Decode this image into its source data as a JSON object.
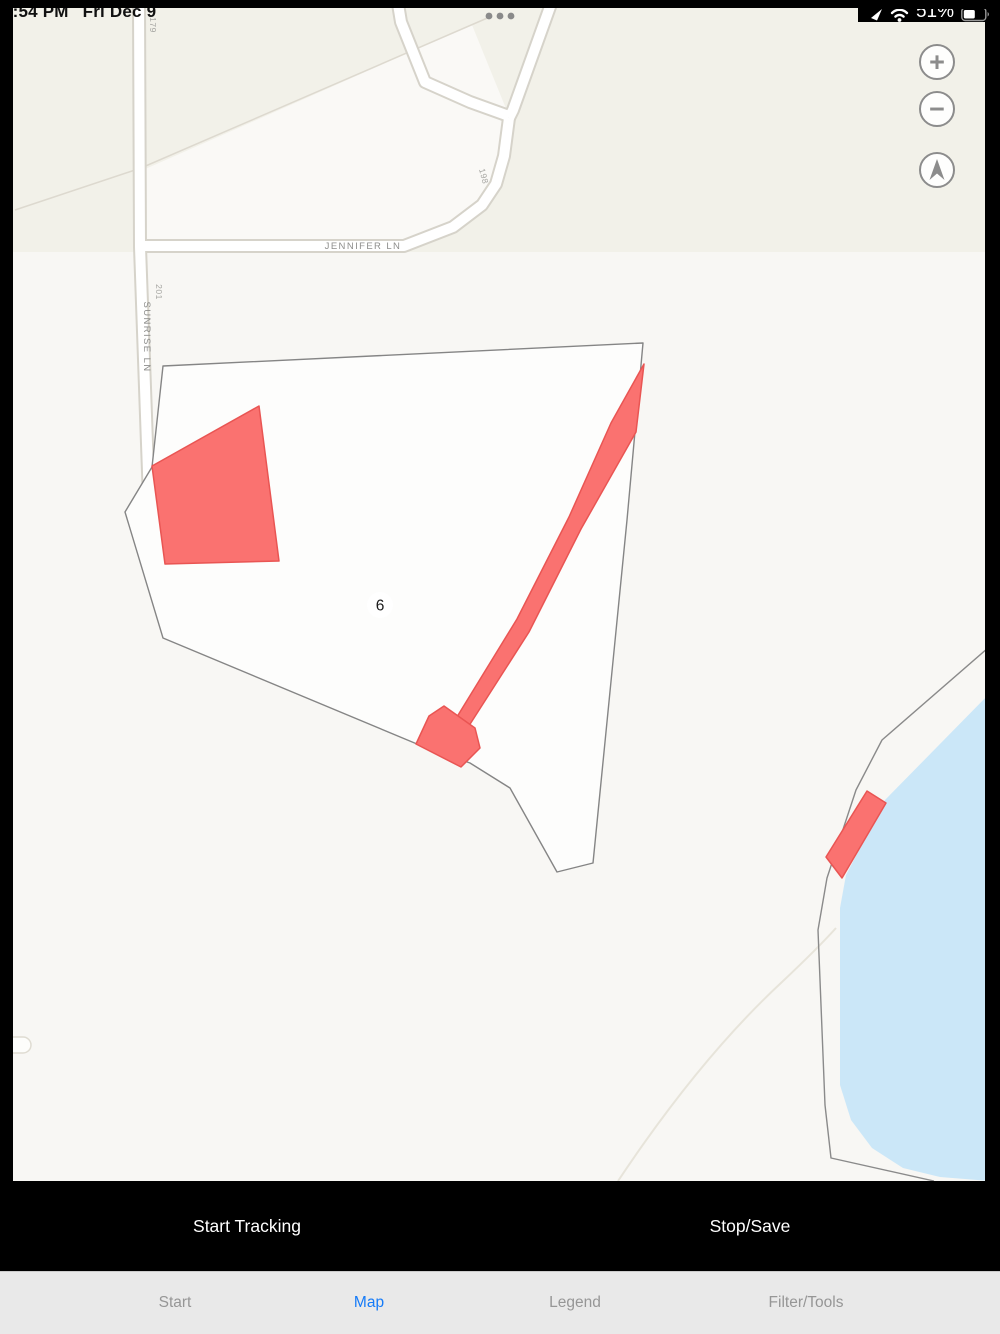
{
  "status_bar": {
    "time": "3:54 PM",
    "date": "Fri Dec 9",
    "battery_percent": "51%",
    "icons": [
      "location-arrow-icon",
      "wifi-icon",
      "battery-icon"
    ]
  },
  "map": {
    "street_labels": {
      "jennifer": "JENNIFER LN",
      "sunrise": "SUNRISE LN"
    },
    "address_labels": {
      "a179": "179",
      "a201": "201",
      "a198": "198"
    },
    "parcel_number": "6",
    "colors": {
      "highlight_red": "#fa7270",
      "highlight_red_stroke": "#e95553",
      "water_blue": "#cbe7f8",
      "parcel_outline_gray": "#858585",
      "map_background": "#f8f7f4"
    }
  },
  "controls": {
    "zoom_in_label": "+",
    "zoom_out_label": "−",
    "compass": "compass-north-icon"
  },
  "action_bar": {
    "start_tracking_label": "Start Tracking",
    "stop_save_label": "Stop/Save"
  },
  "tab_bar": {
    "active_tab": "Map",
    "active_color": "#157bf8",
    "tabs": [
      {
        "label": "Start"
      },
      {
        "label": "Map"
      },
      {
        "label": "Legend"
      },
      {
        "label": "Filter/Tools"
      }
    ]
  }
}
